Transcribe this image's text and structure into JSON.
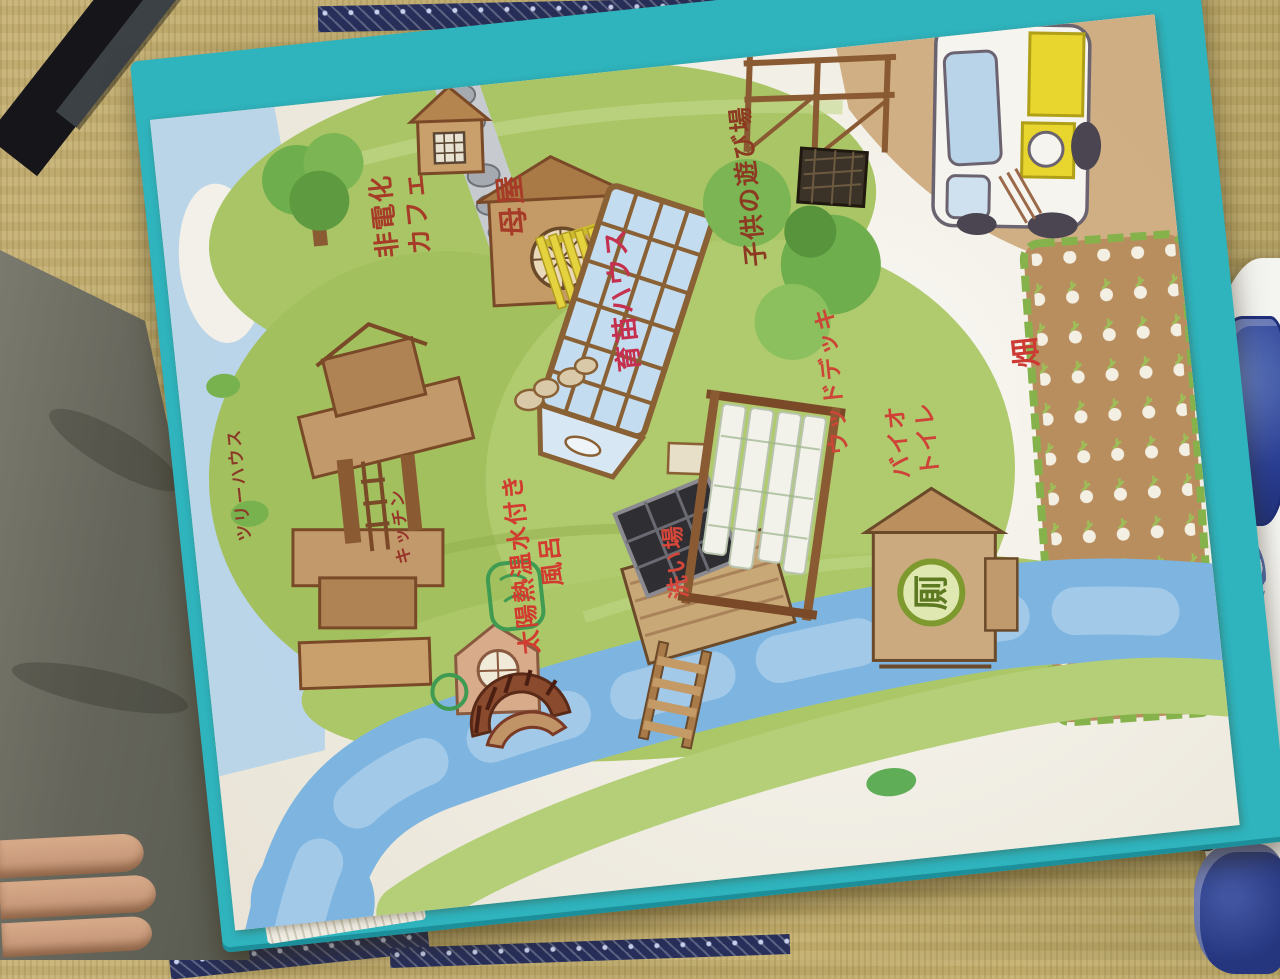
{
  "scene": {
    "description_tagline": "",
    "notebook_cover_color": "#2fb3bd",
    "page_color": "#f4f1e8",
    "river_color": "#7db5e0",
    "grass_color": "#a9c565",
    "tatami_color": "#c3ae70",
    "tatami_border_color": "#272f5a",
    "plate_pattern_color": "#2b3f94",
    "fabric_color": "#65655b",
    "skin_color": "#c99b7c"
  },
  "map": {
    "labels": {
      "cafe": "非電化\nカフェ",
      "main_house": "母屋",
      "greenhouse": "育苗ハウス",
      "play_area": "子供の遊び場",
      "tree_house": "ツリーハウス",
      "kitchen": "キッチン",
      "bath": "太陽熱温水付き\n風呂",
      "washing_area": "洗い場",
      "wood_deck": "ウッドデッキ",
      "bio_toilet": "バイオ\nトイレ",
      "field": "畑"
    },
    "label_colors": {
      "cafe": "#a63c28",
      "main_house": "#a63c28",
      "greenhouse": "#c5304e",
      "play_area": "#8c3a22",
      "tree_house": "#8c3a28",
      "kitchen": "#97342a",
      "bath": "#d23b30",
      "washing_area": "#d5473a",
      "wood_deck": "#cc4536",
      "bio_toilet": "#cf4238",
      "field": "#cc3a33"
    },
    "toilet_sign": "厠"
  }
}
